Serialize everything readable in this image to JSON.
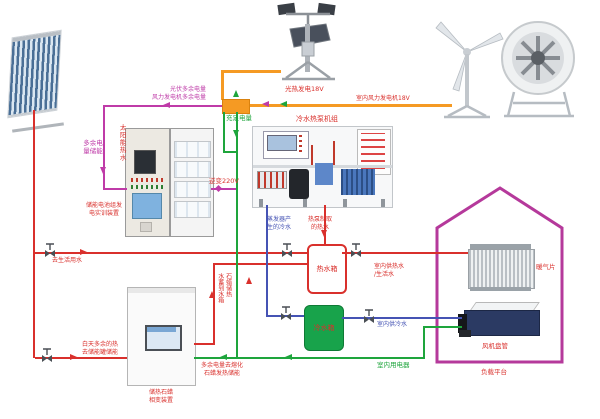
{
  "title": "太阳能/风能冷热电综合实训系统图",
  "colors": {
    "red": "#d9302c",
    "magenta": "#bf3ba8",
    "orange": "#f59a23",
    "green": "#1ea53c",
    "blue": "#4553b4",
    "house": "#b5399b",
    "cold_tank_fill": "#18a34b"
  },
  "labels": {
    "solar_hot_water": "太阳能热水",
    "surplus_to_storage_bus": "光伏多余电量\n风力发电机多余电量",
    "surplus_store": "多余电\n量储能",
    "pv_output": "光热发电18V",
    "wind_output": "室内风力发电机18V",
    "sufficient": "充足电量",
    "inverter": "逆变220V",
    "battery_cabinet": "储能电池组发\n电实训装置",
    "heat_pump": "冷水热泵机组",
    "evap_cold": "蒸发器产\n生的冷水",
    "hp_hot": "热泵制取\n的热水",
    "hot_tank": "热水箱",
    "cold_tank": "冷水箱",
    "to_domestic": "去生活用水",
    "day_heat": "白天多余的热\n去储能罐储能",
    "paraffin_cabinet": "储热石蜡\n相变装置",
    "paraffin_to_tank": "石蜡储热\n水蓄到水箱",
    "melt_paraffin": "多余电量去熔化\n石蜡发热储能",
    "indoor_hot": "室内供热水\n/生活水",
    "indoor_cold": "室内供冷水",
    "indoor_power": "室内用电器",
    "radiator": "暖气片",
    "fan_coil": "风机盘管",
    "load_platform": "负载平台"
  }
}
